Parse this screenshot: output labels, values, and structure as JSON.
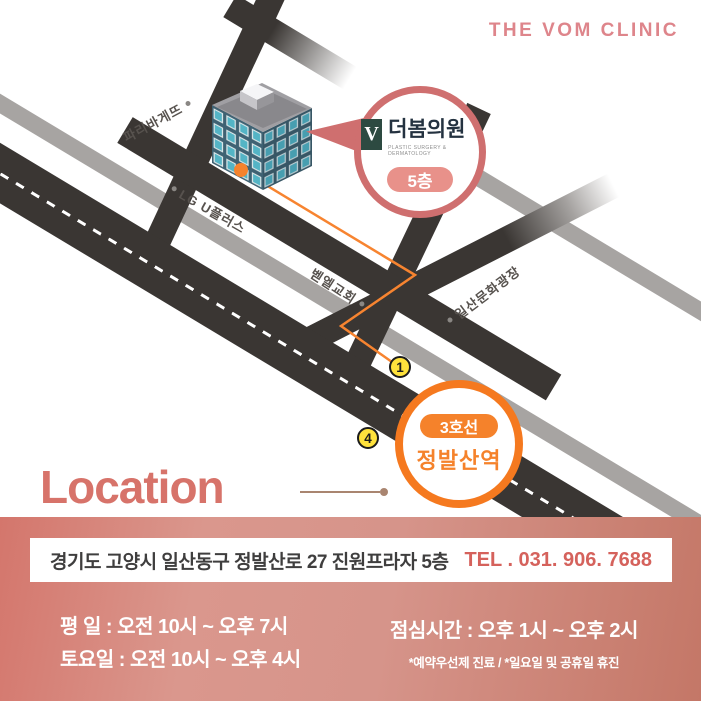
{
  "brand": "THE VOM CLINIC",
  "map": {
    "street_labels": {
      "paris_baguette": "파리바게뜨",
      "lg_uplus": "LG U플러스",
      "bethel_church": "벧엘교회",
      "ilsan_culture_plaza": "일산문화광장"
    },
    "clinic_bubble": {
      "logo_letter": "V",
      "clinic_name": "더봄의원",
      "clinic_subtitle": "PLASTIC SURGERY & DERMATOLOGY",
      "floor_badge": "5층"
    },
    "station": {
      "line_badge": "3호선",
      "station_name": "정발산역"
    },
    "exit_badges": [
      {
        "number": "1"
      },
      {
        "number": "4"
      }
    ]
  },
  "location_section": {
    "title": "Location"
  },
  "footer": {
    "address": "경기도 고양시 일산동구 정발산로 27 진원프라자 5층",
    "tel": "TEL . 031. 906. 7688",
    "hours_weekday": "평   일 : 오전 10시 ~ 오후 7시",
    "hours_saturday": "토요일 : 오전 10시 ~ 오후 4시",
    "lunch": "점심시간 : 오후 1시 ~ 오후 2시",
    "note": "*예약우선제 진료 / *일요일 및 공휴일 휴진"
  },
  "colors": {
    "coral": "#db838a",
    "coral_deep": "#d5625c",
    "bubble_border": "#cf6f6f",
    "orange": "#f5822b",
    "route_orange": "#f5832d",
    "exit_yellow": "#ffe23c",
    "road_dark": "#3a3633",
    "road_gray": "#a7a4a2"
  }
}
